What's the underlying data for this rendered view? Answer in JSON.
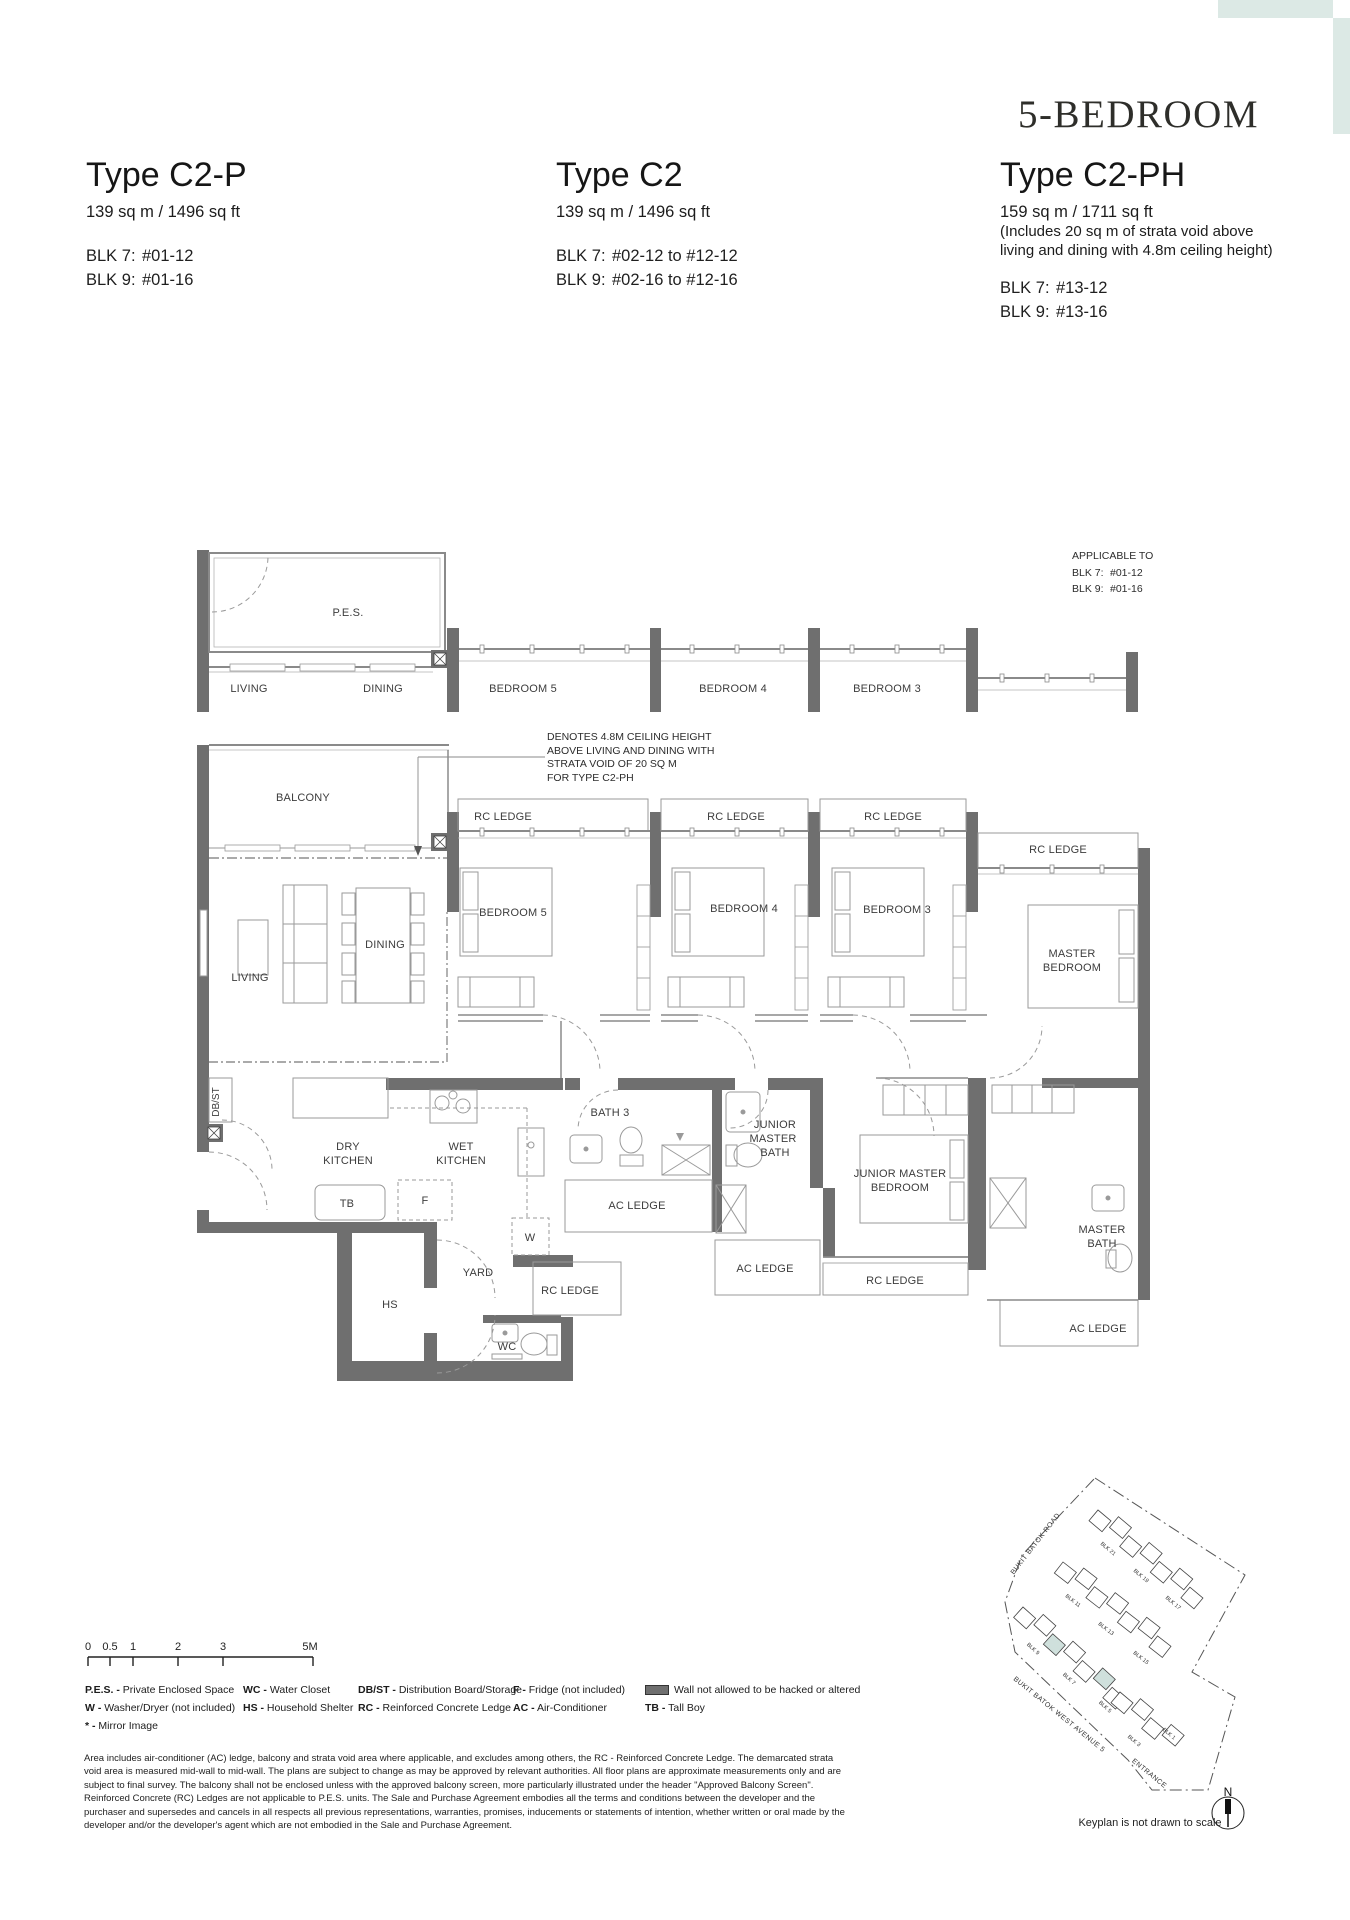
{
  "colors": {
    "accent": "#dce9e5",
    "keyplan_highlight": "#cfe0dc",
    "wall": "#6f6f6f"
  },
  "header": {
    "category": "5-BEDROOM",
    "left": {
      "title": "Type C2-P",
      "area": "139 sq m / 1496 sq ft",
      "blk": [
        {
          "label": "BLK 7:",
          "value": "#01-12"
        },
        {
          "label": "BLK 9:",
          "value": "#01-16"
        }
      ]
    },
    "mid": {
      "title": "Type C2",
      "area": "139 sq m / 1496 sq ft",
      "blk": [
        {
          "label": "BLK 7:",
          "value": "#02-12 to #12-12"
        },
        {
          "label": "BLK 9:",
          "value": "#02-16 to #12-16"
        }
      ]
    },
    "right": {
      "title": "Type C2-PH",
      "area": "159 sq m / 1711 sq ft",
      "note1": "(Includes 20 sq m of strata void above",
      "note2": "living and dining with 4.8m ceiling height)",
      "blk": [
        {
          "label": "BLK 7:",
          "value": "#13-12"
        },
        {
          "label": "BLK 9:",
          "value": "#13-16"
        }
      ]
    }
  },
  "strip_plan": {
    "applicable_title": "APPLICABLE TO",
    "applicable_blk": [
      {
        "label": "BLK 7:",
        "value": "#01-12"
      },
      {
        "label": "BLK 9:",
        "value": "#01-16"
      }
    ],
    "labels": {
      "pes": "P.E.S.",
      "living": "LIVING",
      "dining": "DINING",
      "bedroom5": "BEDROOM 5",
      "bedroom4": "BEDROOM 4",
      "bedroom3": "BEDROOM 3"
    }
  },
  "main_plan": {
    "note": {
      "l1": "DENOTES 4.8M CEILING HEIGHT",
      "l2": "ABOVE LIVING AND DINING WITH",
      "l3": "STRATA VOID OF 20 SQ M",
      "l4": "FOR TYPE C2-PH"
    },
    "labels": {
      "balcony": "BALCONY",
      "living": "LIVING",
      "dining": "DINING",
      "bedroom5": "BEDROOM 5",
      "bedroom4": "BEDROOM 4",
      "bedroom3": "BEDROOM 3",
      "rc_ledge": "RC LEDGE",
      "ac_ledge": "AC LEDGE",
      "master_l1": "MASTER",
      "master_l2": "BEDROOM",
      "jm_bath_l1": "JUNIOR",
      "jm_bath_l2": "MASTER",
      "jm_bath_l3": "BATH",
      "jm_bed_l1": "JUNIOR MASTER",
      "jm_bed_l2": "BEDROOM",
      "m_bath_l1": "MASTER",
      "m_bath_l2": "BATH",
      "bath3": "BATH 3",
      "dbst": "DB/ST",
      "dry": "DRY",
      "wet": "WET",
      "kitchen": "KITCHEN",
      "tb": "TB",
      "f": "F",
      "w": "W",
      "hs": "HS",
      "yard": "YARD",
      "wc": "WC"
    }
  },
  "scalebar": {
    "ticks": [
      "0",
      "0.5",
      "1",
      "2",
      "3",
      "5M"
    ]
  },
  "legend": {
    "c1": [
      {
        "k": "P.E.S. -",
        "d": "Private Enclosed Space"
      },
      {
        "k": "W -",
        "d": "Washer/Dryer (not included)"
      },
      {
        "k": "* -",
        "d": "Mirror Image"
      }
    ],
    "c2": [
      {
        "k": "WC -",
        "d": "Water Closet"
      },
      {
        "k": "HS -",
        "d": "Household Shelter"
      }
    ],
    "c3": [
      {
        "k": "DB/ST -",
        "d": "Distribution Board/Storage"
      },
      {
        "k": "RC -",
        "d": "Reinforced Concrete Ledge"
      }
    ],
    "c4": [
      {
        "k": "F -",
        "d": "Fridge (not included)"
      },
      {
        "k": "AC -",
        "d": "Air-Conditioner"
      }
    ],
    "c5": [
      {
        "k": "",
        "d": "Wall not allowed to be hacked or altered"
      },
      {
        "k": "TB -",
        "d": "Tall Boy"
      }
    ]
  },
  "disclaimer": "Area includes air-conditioner (AC) ledge, balcony and strata void area where applicable, and excludes among others, the RC - Reinforced Concrete Ledge. The demarcated strata void area is measured mid-wall to mid-wall. The plans are subject to change as may be approved by relevant authorities. All floor plans are approximate measurements only and are subject to final survey. The balcony shall not be enclosed unless with the approved balcony screen, more particularly illustrated under the header \"Approved Balcony Screen\". Reinforced Concrete (RC) Ledges are not applicable to P.E.S. units. The Sale and Purchase Agreement embodies all the terms and conditions between the developer and the purchaser and supersedes and cancels in all respects all previous representations, warranties, promises, inducements or statements of intention, whether written or oral made by the developer and/or the developer's agent which are not embodied in the Sale and Purchase Agreement.",
  "keyplan": {
    "road1": "BUKIT BATOK ROAD",
    "road2": "BUKIT BATOK WEST AVENUE 5",
    "entrance": "ENTRANCE",
    "note": "Keyplan is not drawn to scale",
    "north": "N",
    "blocks": [
      "BLK 21",
      "BLK 19",
      "BLK 17",
      "BLK 11",
      "BLK 13",
      "BLK 15",
      "BLK 9",
      "BLK 7",
      "BLK 5",
      "BLK 3",
      "BLK 1"
    ]
  }
}
